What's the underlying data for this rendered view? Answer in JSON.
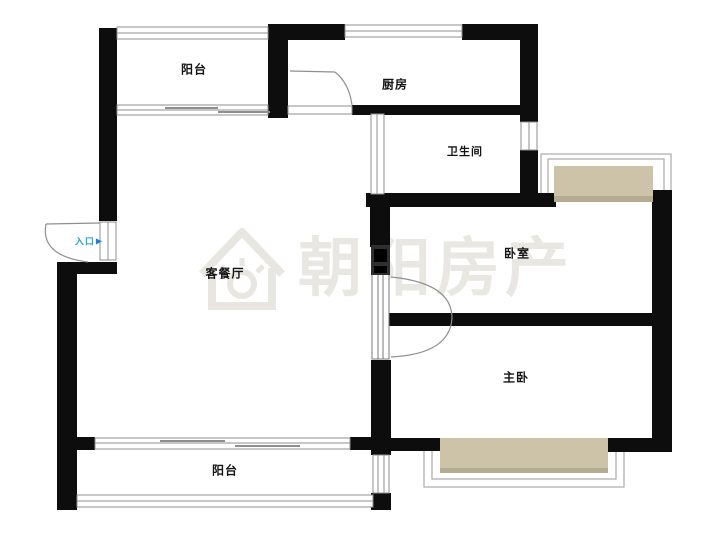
{
  "watermark": {
    "text": "朝阳房产",
    "icon": "house-sun-logo"
  },
  "entrance": {
    "label": "入口",
    "arrow": "▶"
  },
  "rooms": {
    "balcony_top": "阳台",
    "kitchen": "厨房",
    "bathroom": "卫生间",
    "bedroom": "卧室",
    "master_bedroom": "主卧",
    "living_dining": "客餐厅",
    "balcony_bottom": "阳台"
  },
  "colors": {
    "wall": "#0d0d0d",
    "line": "#8f8f8f",
    "frame": "#aaaaaa",
    "bay_window_fill": "#cdc3a8",
    "bay_window_edge": "#b5ab91",
    "door_frame_gray": "#2f2f2f",
    "entrance_blue": "#1e9fe2",
    "watermark_gray": "#e9e7e2",
    "background": "#ffffff"
  }
}
